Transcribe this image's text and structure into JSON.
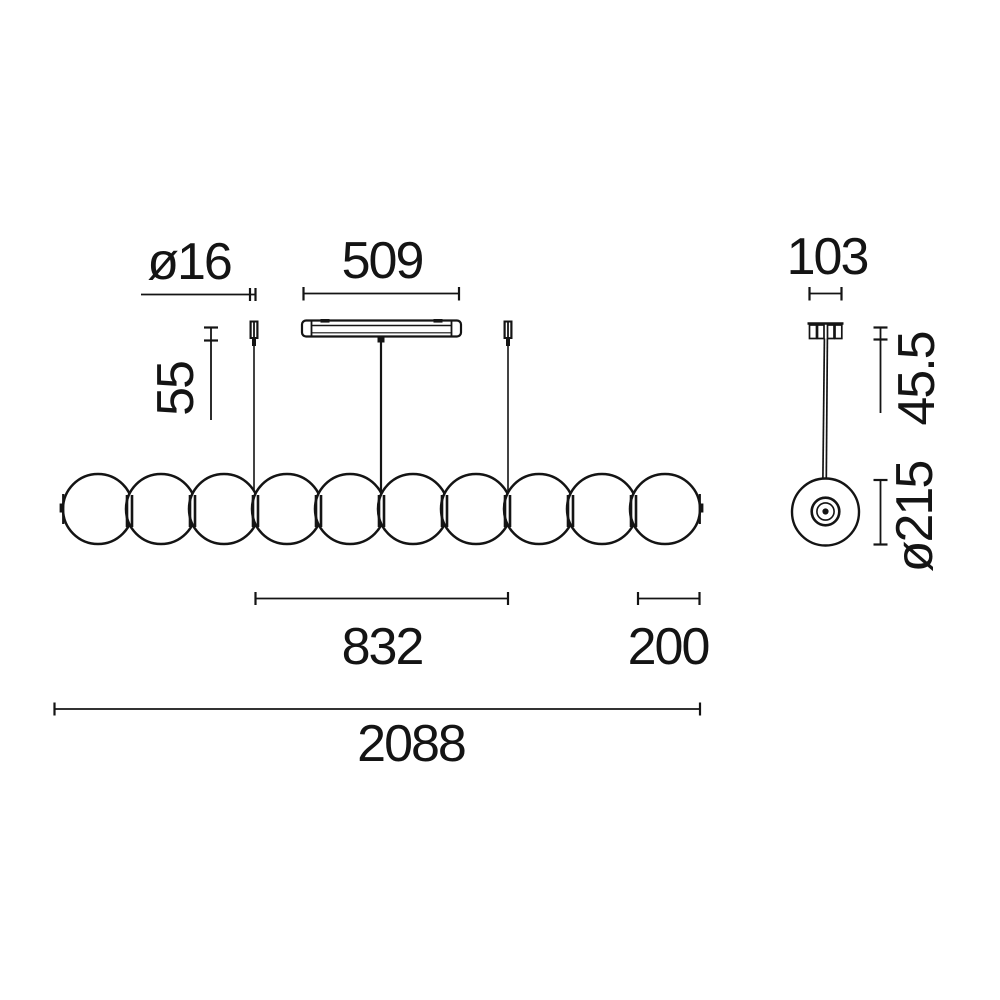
{
  "page": {
    "background_color": "#ffffff",
    "line_color": "#141414"
  },
  "views": {
    "front": {
      "name": "front-view",
      "sphere_count": 10,
      "dimensions": {
        "cable_diameter": "ø16",
        "canopy_length": "509",
        "cable_gripper_drop": "55",
        "suspension_span": "832",
        "end_module_length": "200",
        "overall_length": "2088"
      }
    },
    "side": {
      "name": "side-view",
      "dimensions": {
        "canopy_width": "103",
        "stem_drop": "45.5",
        "sphere_diameter": "ø215"
      }
    }
  }
}
